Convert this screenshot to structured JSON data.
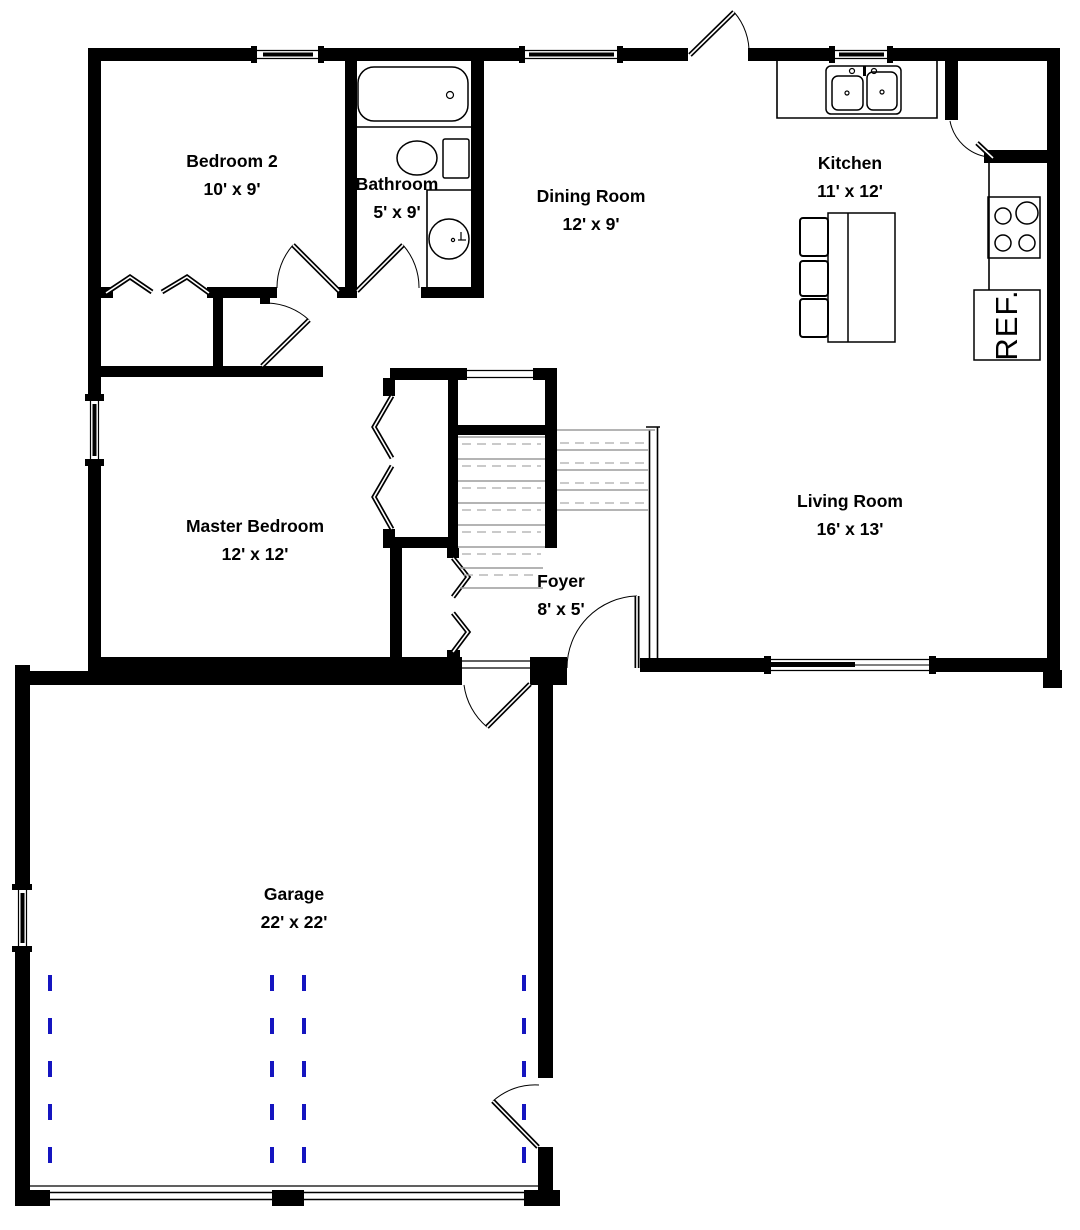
{
  "title": "First floor plan",
  "rooms": [
    {
      "id": "bedroom2",
      "name": "Bedroom 2",
      "dims": "10' x 9'"
    },
    {
      "id": "bathroom",
      "name": "Bathroom",
      "dims": "5' x 9'"
    },
    {
      "id": "dining",
      "name": "Dining Room",
      "dims": "12' x 9'"
    },
    {
      "id": "kitchen",
      "name": "Kitchen",
      "dims": "11' x 12'"
    },
    {
      "id": "master",
      "name": "Master Bedroom",
      "dims": "12' x 12'"
    },
    {
      "id": "living",
      "name": "Living Room",
      "dims": "16' x 13'"
    },
    {
      "id": "foyer",
      "name": "Foyer",
      "dims": "8' x 5'"
    },
    {
      "id": "garage",
      "name": "Garage",
      "dims": "22' x 22'"
    }
  ],
  "appliances": {
    "refrigerator": "REF."
  },
  "colors": {
    "wall": "#000000",
    "background": "#ffffff",
    "stair_solid": "#9b9b9b",
    "stair_dash": "#ababab",
    "garage_track_blue": "#1515c0"
  }
}
